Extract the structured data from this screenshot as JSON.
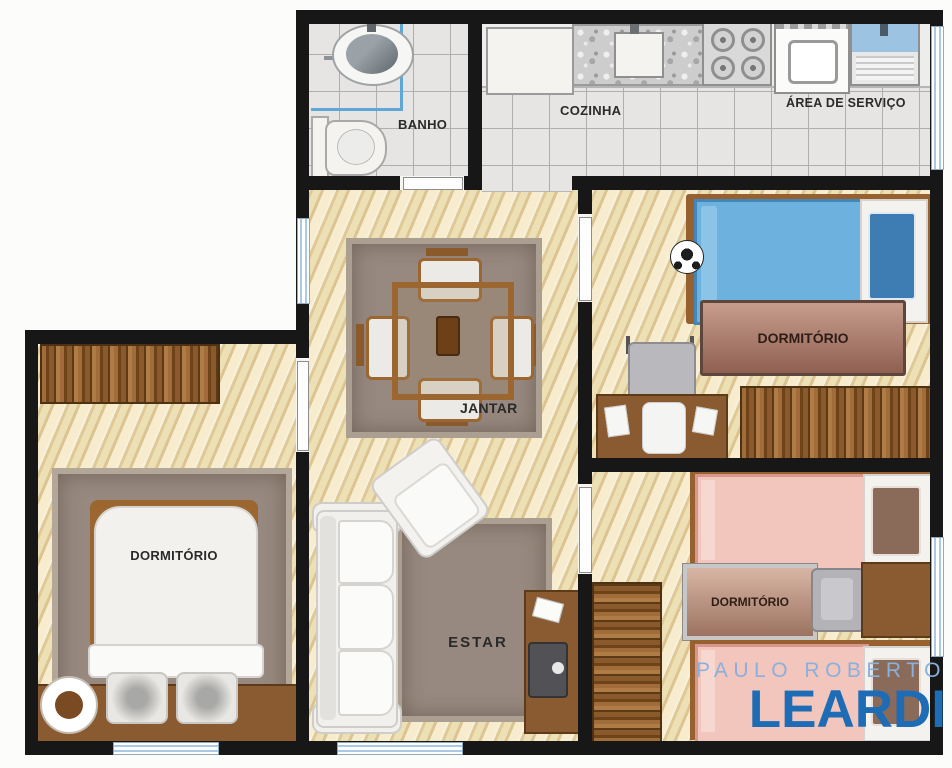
{
  "plan": {
    "title": "apartment-floor-plan",
    "rooms": {
      "banho": {
        "label": "BANHO"
      },
      "cozinha": {
        "label": "COZINHA"
      },
      "servico": {
        "label": "ÁREA DE SERVIÇO"
      },
      "dorm_top_right": {
        "label": "DORMITÓRIO"
      },
      "dorm_left": {
        "label": "DORMITÓRIO"
      },
      "dorm_bottom_right": {
        "label": "DORMITÓRIO"
      },
      "jantar": {
        "label": "JANTAR"
      },
      "estar": {
        "label": "ESTAR"
      }
    },
    "colors": {
      "wall": "#171717",
      "wood_floor": "#eedfb4",
      "tile_floor": "#e6e5e3",
      "rug": "#97897f",
      "furniture_wood": "#8a5a30",
      "bed_blue": "#6db1de",
      "pillow_blue": "#3d7db3",
      "bed_pink": "#f2c5bd",
      "window_blue": "#a9c9e4",
      "label_text": "#2a2a2a"
    }
  },
  "logo": {
    "line1": "PAULO ROBERTO",
    "line2": "LEARDI",
    "line1_color": "#8ab0dc",
    "line2_color": "#1e6cb5"
  }
}
